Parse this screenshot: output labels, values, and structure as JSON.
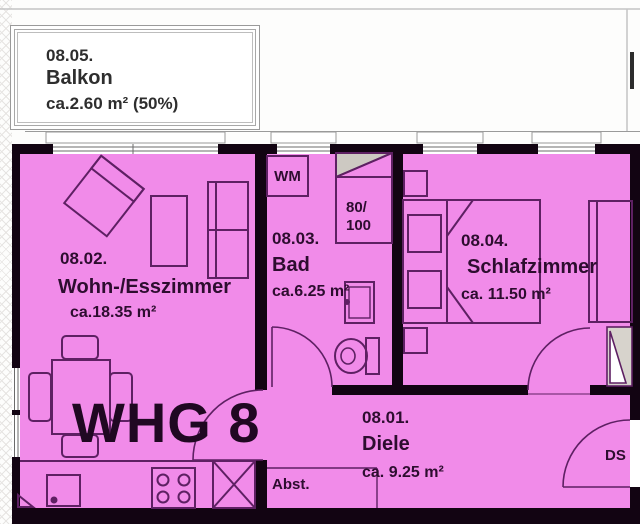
{
  "plan": {
    "apartment_label": "WHG 8",
    "rooms": {
      "balkon": {
        "number": "08.05.",
        "name": "Balkon",
        "area": "ca.2.60 m² (50%)"
      },
      "diele": {
        "number": "08.01.",
        "name": "Diele",
        "area": "ca. 9.25 m²"
      },
      "wohn_esszimmer": {
        "number": "08.02.",
        "name": "Wohn-/Esszimmer",
        "area": "ca.18.35 m²"
      },
      "bad": {
        "number": "08.03.",
        "name": "Bad",
        "area": "ca.6.25 m²"
      },
      "schlafzimmer": {
        "number": "08.04.",
        "name": "Schlafzimmer",
        "area": "ca. 11.50 m²"
      }
    },
    "annotations": {
      "washing_machine": "WM",
      "shower_dim_line1": "80/",
      "shower_dim_line2": "100",
      "storage": "Abst.",
      "duct": "DS"
    },
    "colors": {
      "room_fill": "#f18be9",
      "wall": "#120412",
      "furniture_line": "#5e2063",
      "label_text": "#2d0d2f",
      "shower_gray": "#cdc9c2",
      "balcony_border": "#9a9a9a"
    }
  }
}
